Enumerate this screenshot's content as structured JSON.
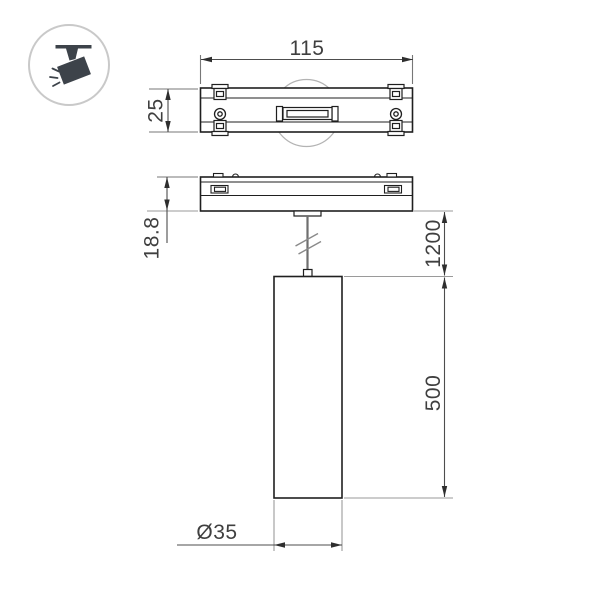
{
  "drawing": {
    "type": "technical-dimension-drawing",
    "product": "suspended cylindrical track spotlight",
    "views": [
      "track-adapter-top-view",
      "track-adapter-side-view-with-pendant"
    ]
  },
  "icon": {
    "name": "track-spotlight-icon"
  },
  "dimensions": {
    "track_width": "115",
    "track_depth": "25",
    "adapter_height": "18.8",
    "suspension_length": "1200",
    "body_length": "500",
    "body_diameter": "Ø35"
  },
  "colors": {
    "background": "#ffffff",
    "outline": "#1f1f1f",
    "dimension_line": "#4d4d4d",
    "extension_line_dark": "#777777",
    "extension_line_light": "#9a9a9a",
    "dimension_text": "#3f3f3f",
    "construction_circle": "#b3b3b3",
    "wire": "#6f6f6f",
    "icon_fill": "#3d434a",
    "icon_circle_border": "#c9c9c9"
  }
}
